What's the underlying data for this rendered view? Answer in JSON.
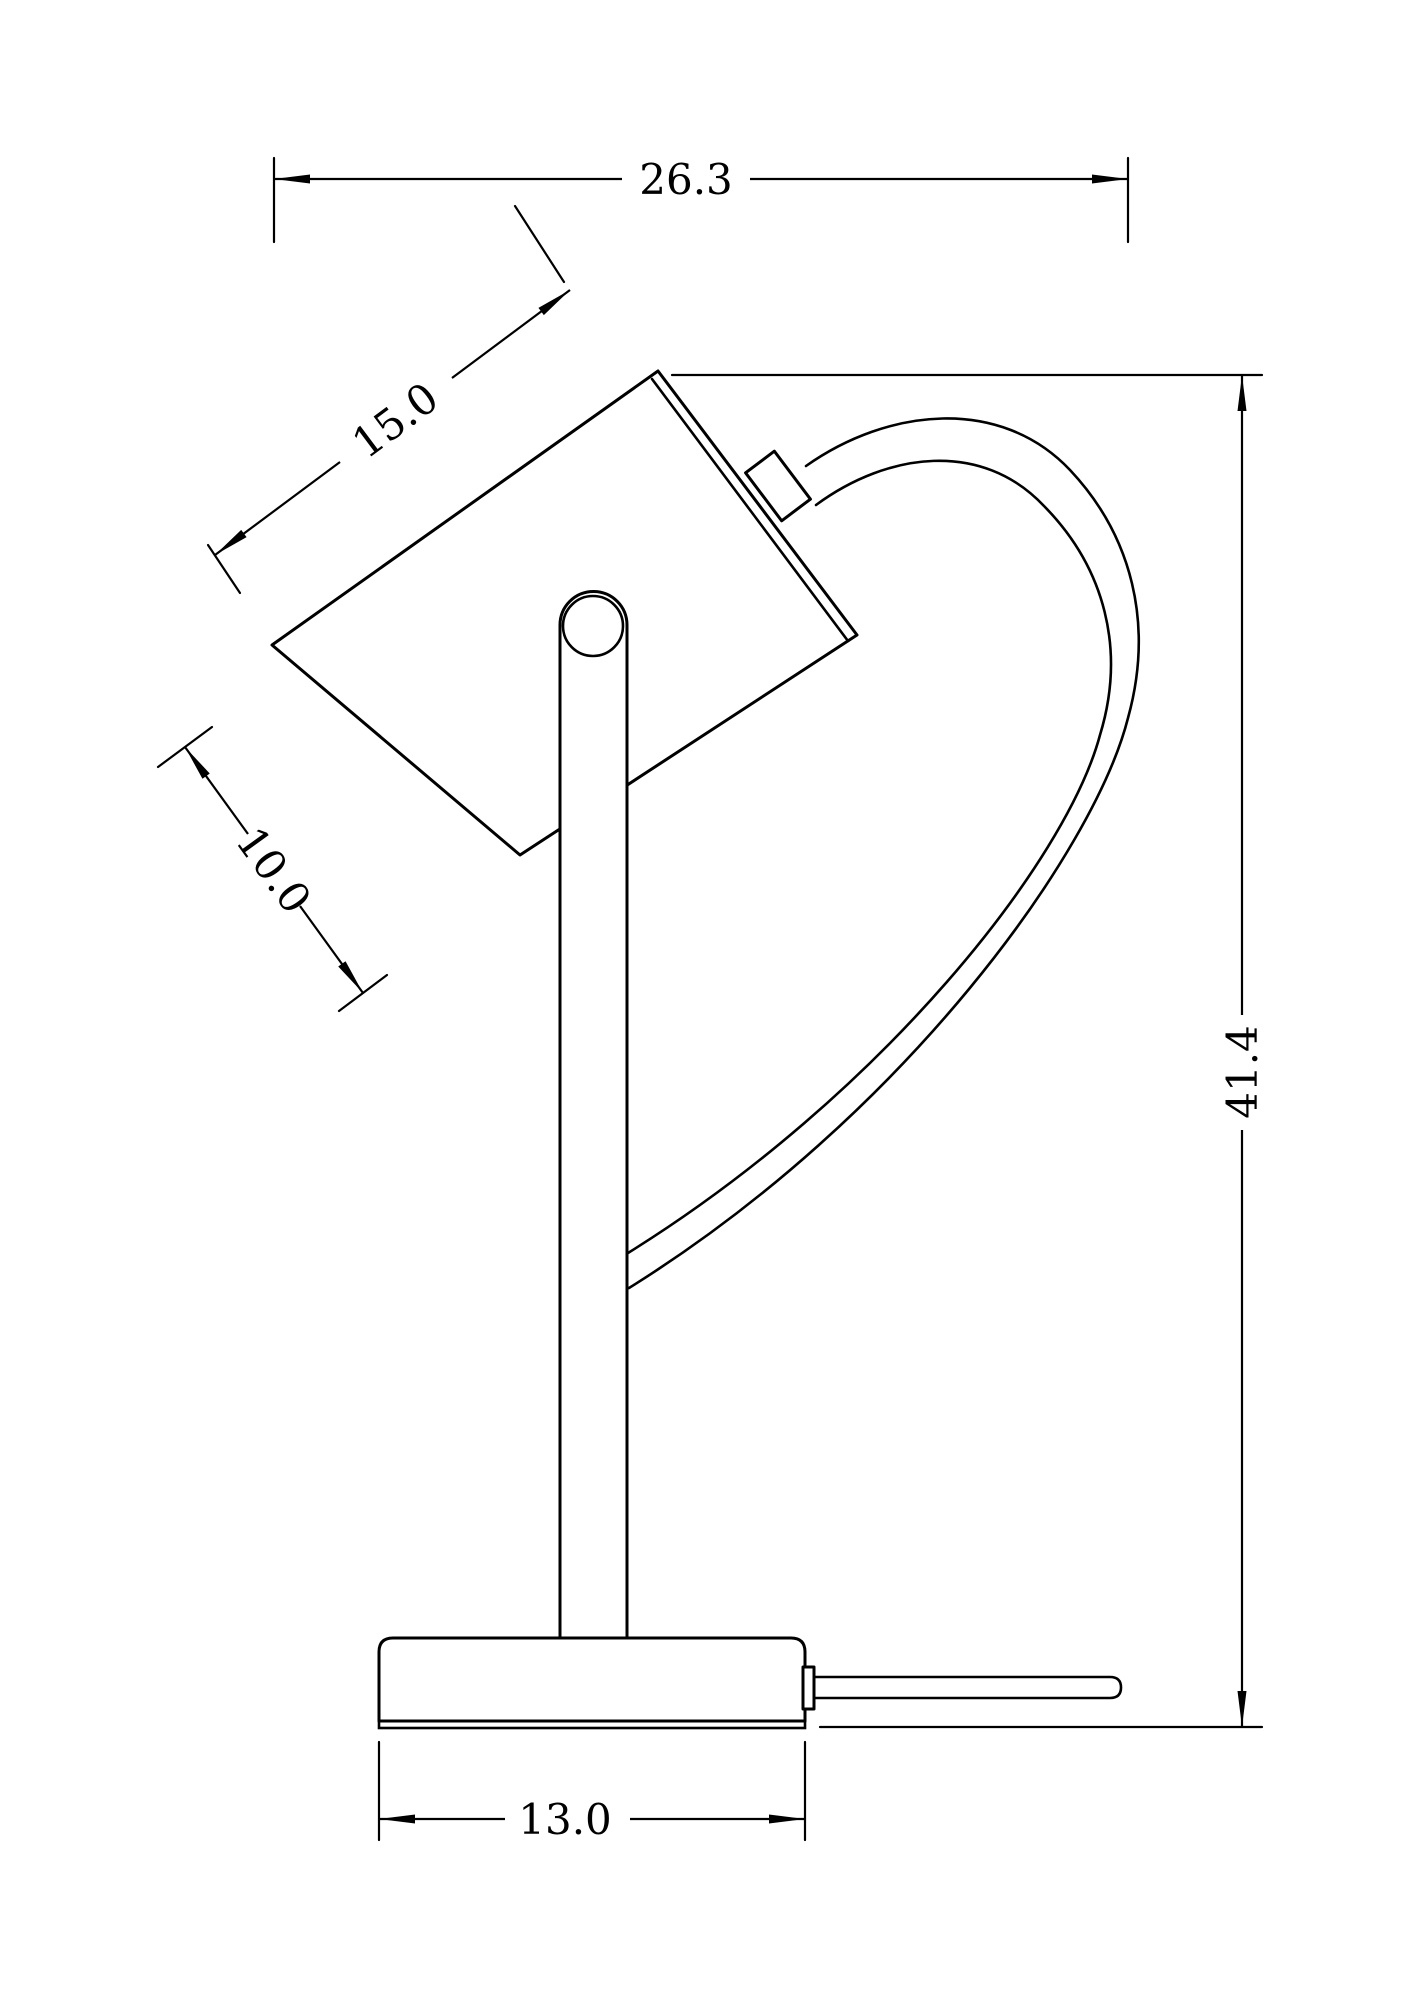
{
  "drawing": {
    "title": "table-lamp-dimension-drawing",
    "colors": {
      "line": "#000000",
      "background": "#ffffff"
    },
    "dimensions": {
      "overall_width": "26.3",
      "shade_length": "15.0",
      "shade_diameter": "10.0",
      "overall_height": "41.4",
      "base_width": "13.0"
    }
  }
}
